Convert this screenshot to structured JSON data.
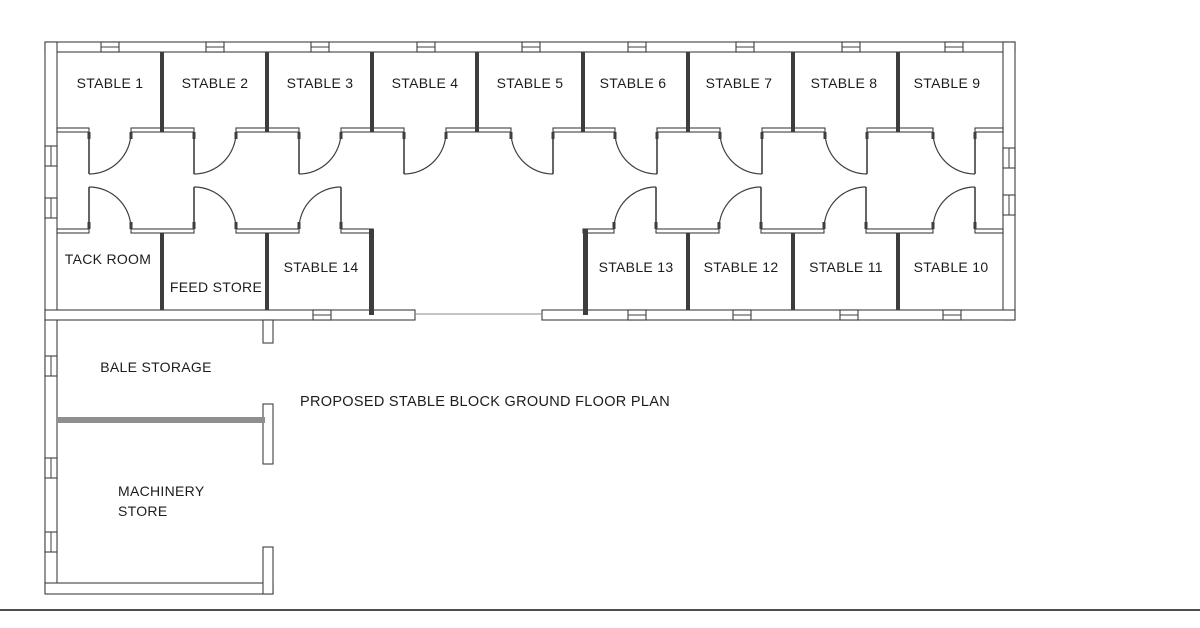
{
  "title": {
    "text": "PROPOSED STABLE BLOCK GROUND FLOOR PLAN"
  },
  "colors": {
    "background": "#ffffff",
    "wall_line": "#3f3f3f",
    "solid_wall": "#3d3d3d",
    "gray_partition": "#8f8f8f",
    "threshold_line": "#8a8a8a",
    "page_line": "#4d4d4d",
    "text": "#1c1c1c"
  },
  "rooms": [
    {
      "id": "stable-1",
      "label": "STABLE 1",
      "lx": 110,
      "ly": 83
    },
    {
      "id": "stable-2",
      "label": "STABLE 2",
      "lx": 215,
      "ly": 83
    },
    {
      "id": "stable-3",
      "label": "STABLE 3",
      "lx": 320,
      "ly": 83
    },
    {
      "id": "stable-4",
      "label": "STABLE 4",
      "lx": 425,
      "ly": 83
    },
    {
      "id": "stable-5",
      "label": "STABLE 5",
      "lx": 530,
      "ly": 83
    },
    {
      "id": "stable-6",
      "label": "STABLE 6",
      "lx": 633,
      "ly": 83
    },
    {
      "id": "stable-7",
      "label": "STABLE 7",
      "lx": 739,
      "ly": 83
    },
    {
      "id": "stable-8",
      "label": "STABLE 8",
      "lx": 844,
      "ly": 83
    },
    {
      "id": "stable-9",
      "label": "STABLE 9",
      "lx": 947,
      "ly": 83
    },
    {
      "id": "tack-room",
      "label": "TACK ROOM",
      "lx": 108,
      "ly": 259
    },
    {
      "id": "feed-store",
      "label": "FEED STORE",
      "lx": 216,
      "ly": 287
    },
    {
      "id": "stable-14",
      "label": "STABLE 14",
      "lx": 321,
      "ly": 267
    },
    {
      "id": "stable-13",
      "label": "STABLE 13",
      "lx": 636,
      "ly": 267
    },
    {
      "id": "stable-12",
      "label": "STABLE 12",
      "lx": 741,
      "ly": 267
    },
    {
      "id": "stable-11",
      "label": "STABLE 11",
      "lx": 846,
      "ly": 267
    },
    {
      "id": "stable-10",
      "label": "STABLE 10",
      "lx": 951,
      "ly": 267
    },
    {
      "id": "bale-storage",
      "label": "BALE STORAGE",
      "lx": 156,
      "ly": 367
    },
    {
      "id": "machinery-store",
      "label": "MACHINERY\nSTORE",
      "lx": 162,
      "ly": 500,
      "align": "left",
      "left": 118,
      "top": 481
    }
  ],
  "plan": {
    "hollow_walls": [
      {
        "name": "top-exterior-wall",
        "x": 45,
        "y": 42,
        "w": 970,
        "h": 10
      },
      {
        "name": "left-exterior-wall",
        "x": 45,
        "y": 42,
        "w": 12,
        "h": 551
      },
      {
        "name": "right-exterior-wall",
        "x": 1003,
        "y": 42,
        "w": 12,
        "h": 278
      },
      {
        "name": "south-wall-west",
        "x": 45,
        "y": 310,
        "w": 370,
        "h": 10
      },
      {
        "name": "south-wall-east",
        "x": 542,
        "y": 310,
        "w": 473,
        "h": 10
      },
      {
        "name": "machinery-bottom-wall",
        "x": 45,
        "y": 583,
        "w": 228,
        "h": 11
      },
      {
        "name": "bale-opening-jamb",
        "x": 263,
        "y": 320,
        "w": 10,
        "h": 23
      },
      {
        "name": "partition-end-pilaster",
        "x": 263,
        "y": 404,
        "w": 10,
        "h": 60
      },
      {
        "name": "machinery-opening-jamb",
        "x": 263,
        "y": 547,
        "w": 10,
        "h": 47
      }
    ],
    "corridor": {
      "north_y": 128,
      "south_y": 229,
      "wall_h": 4,
      "north_range": [
        57,
        1003
      ],
      "south_ranges": [
        [
          57,
          373
        ],
        [
          583,
          1003
        ]
      ]
    },
    "door_width": 42,
    "leaf_length": 42,
    "doors_top": [
      {
        "room": "stable-1",
        "x": 89,
        "hinge": "left"
      },
      {
        "room": "stable-2",
        "x": 194,
        "hinge": "left"
      },
      {
        "room": "stable-3",
        "x": 299,
        "hinge": "left"
      },
      {
        "room": "stable-4",
        "x": 404,
        "hinge": "left"
      },
      {
        "room": "stable-5",
        "x": 511,
        "hinge": "right"
      },
      {
        "room": "stable-6",
        "x": 615,
        "hinge": "right"
      },
      {
        "room": "stable-7",
        "x": 720,
        "hinge": "right"
      },
      {
        "room": "stable-8",
        "x": 825,
        "hinge": "right"
      },
      {
        "room": "stable-9",
        "x": 933,
        "hinge": "right"
      }
    ],
    "doors_bottom": [
      {
        "room": "tack-room",
        "x": 89,
        "hinge": "left"
      },
      {
        "room": "feed-store",
        "x": 194,
        "hinge": "left"
      },
      {
        "room": "stable-14",
        "x": 299,
        "hinge": "right"
      },
      {
        "room": "stable-13",
        "x": 614,
        "hinge": "right"
      },
      {
        "room": "stable-12",
        "x": 719,
        "hinge": "right"
      },
      {
        "room": "stable-11",
        "x": 824,
        "hinge": "right"
      },
      {
        "room": "stable-10",
        "x": 933,
        "hinge": "right"
      }
    ],
    "dividers": [
      {
        "name": "divider-stable-1-2",
        "x": 160,
        "y": 52,
        "w": 4,
        "h": 80
      },
      {
        "name": "divider-stable-2-3",
        "x": 265,
        "y": 52,
        "w": 4,
        "h": 80
      },
      {
        "name": "divider-stable-3-4",
        "x": 370,
        "y": 52,
        "w": 4,
        "h": 80
      },
      {
        "name": "divider-stable-4-5",
        "x": 475,
        "y": 52,
        "w": 4,
        "h": 80
      },
      {
        "name": "divider-stable-5-6",
        "x": 581,
        "y": 52,
        "w": 4,
        "h": 80
      },
      {
        "name": "divider-stable-6-7",
        "x": 686,
        "y": 52,
        "w": 4,
        "h": 80
      },
      {
        "name": "divider-stable-7-8",
        "x": 791,
        "y": 52,
        "w": 4,
        "h": 80
      },
      {
        "name": "divider-stable-8-9",
        "x": 896,
        "y": 52,
        "w": 4,
        "h": 80
      },
      {
        "name": "divider-tack-feed",
        "x": 160,
        "y": 233,
        "w": 4,
        "h": 77
      },
      {
        "name": "divider-feed-stable14",
        "x": 265,
        "y": 233,
        "w": 4,
        "h": 77
      },
      {
        "name": "stable-14-end-wall",
        "x": 369,
        "y": 229,
        "w": 5,
        "h": 86
      },
      {
        "name": "stable-13-end-wall",
        "x": 583,
        "y": 229,
        "w": 5,
        "h": 86
      },
      {
        "name": "divider-stable-13-12",
        "x": 686,
        "y": 233,
        "w": 4,
        "h": 77
      },
      {
        "name": "divider-stable-12-11",
        "x": 791,
        "y": 233,
        "w": 4,
        "h": 77
      },
      {
        "name": "divider-stable-11-10",
        "x": 896,
        "y": 233,
        "w": 4,
        "h": 77
      }
    ],
    "windows": {
      "top": [
        110,
        215,
        320,
        426,
        531,
        637,
        745,
        851,
        954
      ],
      "bottom": [
        322,
        637,
        742,
        849,
        952
      ],
      "left": [
        156,
        208,
        366,
        468,
        542
      ],
      "right": [
        158,
        205
      ]
    },
    "gray_partition": {
      "x": 57,
      "y": 417,
      "w": 208,
      "h": 6
    },
    "threshold": {
      "x1": 415,
      "x2": 542,
      "y": 314
    },
    "page_line": {
      "x": 0,
      "y": 609,
      "w": 1200,
      "h": 2
    }
  }
}
